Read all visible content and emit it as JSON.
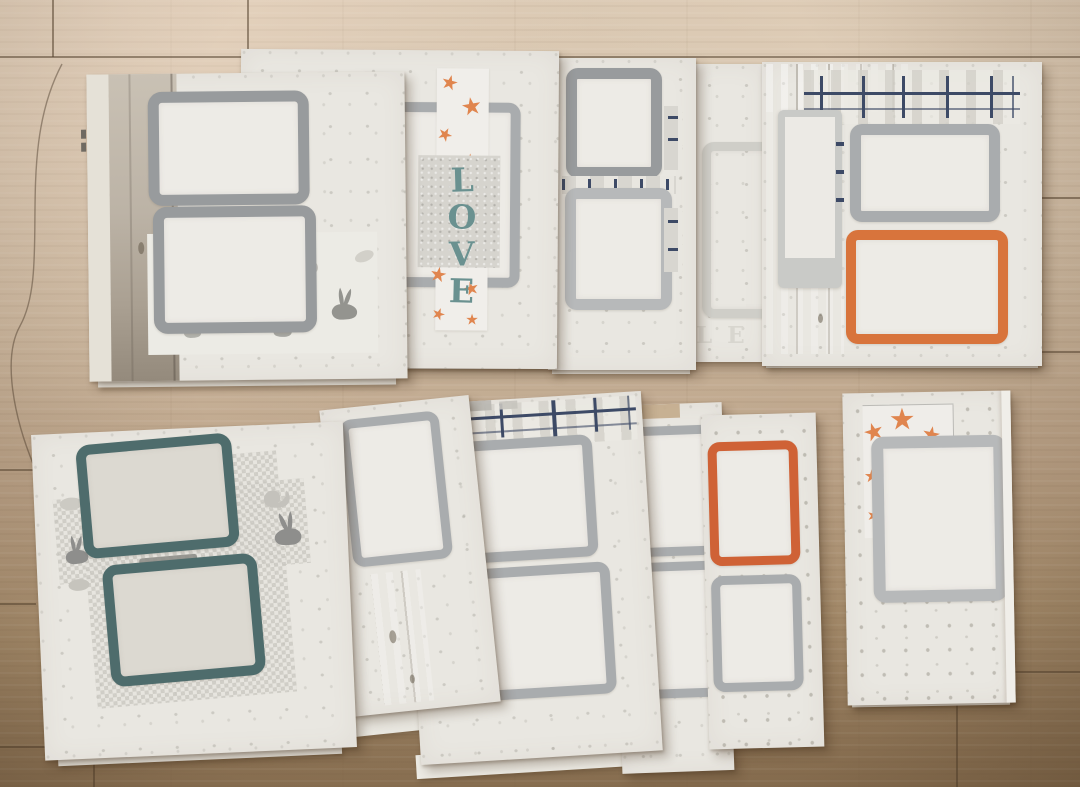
{
  "scene": {
    "alt": "Photograph of handmade scrapbook album pages arranged in two rows on a light wooden floor"
  },
  "decor": {
    "love_letters": [
      "L",
      "O",
      "V",
      "E"
    ],
    "faint_letters": "LE"
  },
  "colors": {
    "page_cream": "#e9e7e1",
    "frame_gray": "#989b9d",
    "frame_gray_light": "#b7b9ba",
    "frame_teal": "#4e6c6c",
    "frame_orange": "#d8743c",
    "frame_orange_deep": "#cf6236",
    "plaid_navy": "#3d4a66",
    "star_orange": "#e0854e",
    "love_teal": "#6a9190",
    "wood_whitewash": "#cdc5b8",
    "wood_line": "#8d8476",
    "bunny_gray": "#9b9b99",
    "pattern_gray": "#c9c7c0",
    "floor_light": "#dbc9b3",
    "floor_dark": "#8c7253",
    "floor_seam": "#7d6a52",
    "faint_gray": "#d8d6cf"
  }
}
